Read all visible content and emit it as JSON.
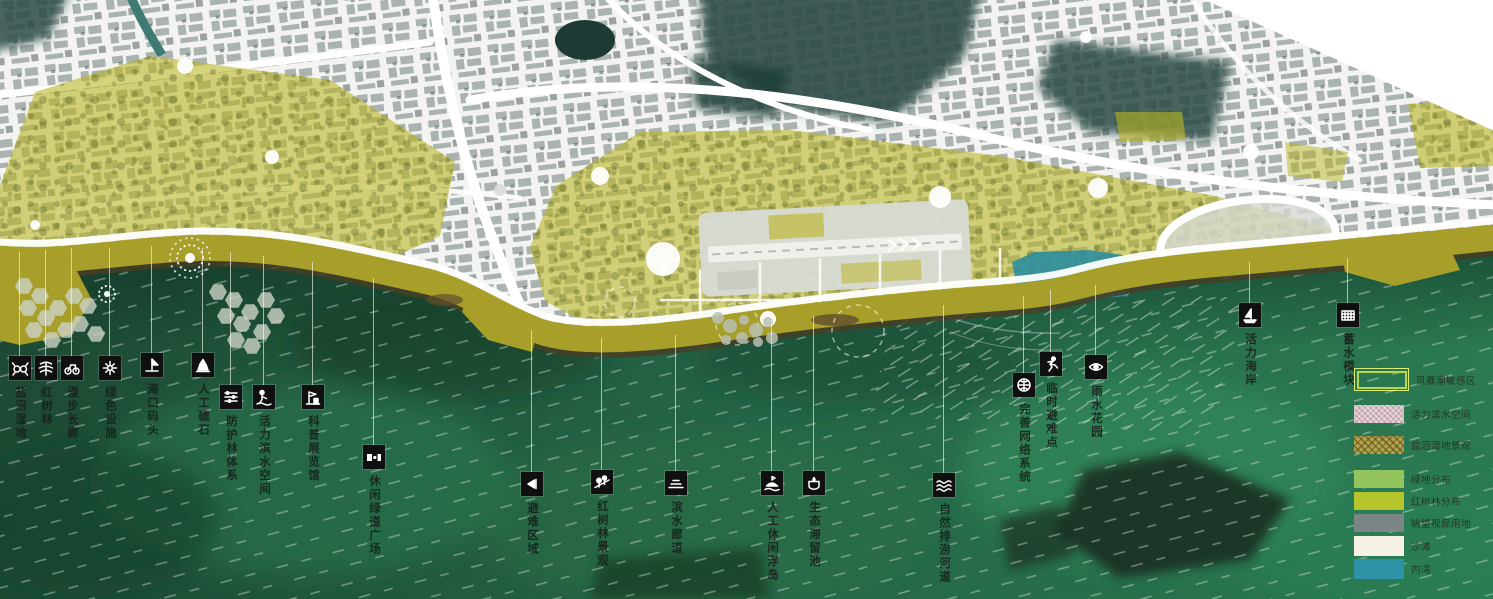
{
  "map": {
    "type": "coastal-urban-masterplan",
    "colors": {
      "sea_deep": "#1d4f38",
      "sea_light": "#2e8155",
      "coast_band": "#a89f2b",
      "coast_shadow": "#453e24",
      "overlay_olive": "#b9b41f",
      "city_base": "#f3f4f2",
      "hill_teal": "#2c4b46",
      "inner_bay": "#2e8e9e",
      "icon_bg": "#101010",
      "label_text": "#2c332e"
    }
  },
  "callouts": {
    "items": [
      {
        "label": "盐沼湿地",
        "icon": "salt-marsh-icon",
        "x": 20,
        "icon_y": 356,
        "line_from": 252
      },
      {
        "label": "红树林",
        "icon": "mangrove-tree-icon",
        "x": 46,
        "icon_y": 356,
        "line_from": 250
      },
      {
        "label": "漫步长廊",
        "icon": "bicycle-icon",
        "x": 72,
        "icon_y": 356,
        "line_from": 248
      },
      {
        "label": "绿色设施",
        "icon": "green-facility-icon",
        "x": 110,
        "icon_y": 356,
        "line_from": 248
      },
      {
        "label": "海口码头",
        "icon": "wharf-sail-icon",
        "x": 152,
        "icon_y": 353,
        "line_from": 246
      },
      {
        "label": "人工礁石",
        "icon": "reef-rock-icon",
        "x": 203,
        "icon_y": 353,
        "line_from": 248
      },
      {
        "label": "防护林体系",
        "icon": "shelter-forest-icon",
        "x": 231,
        "icon_y": 385,
        "line_from": 252
      },
      {
        "label": "活力滨水空间",
        "icon": "waterfront-space-icon",
        "x": 264,
        "icon_y": 385,
        "line_from": 256
      },
      {
        "label": "科普展览馆",
        "icon": "exhibition-hall-icon",
        "x": 313,
        "icon_y": 385,
        "line_from": 262
      },
      {
        "label": "休闲绿道广场",
        "icon": "greenway-plaza-icon",
        "x": 374,
        "icon_y": 445,
        "line_from": 278
      },
      {
        "label": "避难区域",
        "icon": "refuge-area-icon",
        "x": 532,
        "icon_y": 472,
        "line_from": 330
      },
      {
        "label": "红树林景观",
        "icon": "mangrove-view-icon",
        "x": 602,
        "icon_y": 470,
        "line_from": 338
      },
      {
        "label": "滨水廊道",
        "icon": "waterfront-corridor-icon",
        "x": 676,
        "icon_y": 471,
        "line_from": 335
      },
      {
        "label": "人工休闲浮岛",
        "icon": "floating-island-icon",
        "x": 772,
        "icon_y": 471,
        "line_from": 320
      },
      {
        "label": "生态滞留池",
        "icon": "retention-pond-icon",
        "x": 814,
        "icon_y": 471,
        "line_from": 316
      },
      {
        "label": "自然排涝河道",
        "icon": "drainage-channel-icon",
        "x": 944,
        "icon_y": 473,
        "line_from": 305
      },
      {
        "label": "完善网络系统",
        "icon": "network-system-icon",
        "x": 1024,
        "icon_y": 373,
        "line_from": 296
      },
      {
        "label": "临时避难点",
        "icon": "evacuation-point-icon",
        "x": 1051,
        "icon_y": 352,
        "line_from": 290
      },
      {
        "label": "雨水花园",
        "icon": "rain-garden-icon",
        "x": 1096,
        "icon_y": 355,
        "line_from": 285
      },
      {
        "label": "活力海岸",
        "icon": "active-coast-icon",
        "x": 1250,
        "icon_y": 303,
        "line_from": 262
      },
      {
        "label": "蓄水模块",
        "icon": "water-storage-icon",
        "x": 1348,
        "icon_y": 303,
        "line_from": 258
      }
    ]
  },
  "legend": {
    "items": [
      {
        "label": "风暴潮敏感区",
        "type": "outline",
        "color": "#b6d74c"
      },
      {
        "label": "活力滨水空间",
        "type": "hatch_pink",
        "color": "#c6a8b1"
      },
      {
        "label": "盐沼湿地景观",
        "type": "hatch_khaki",
        "color": "#b3a44c"
      },
      {
        "label": "绿地分布",
        "type": "solid",
        "color": "#93c35c"
      },
      {
        "label": "红树林分布",
        "type": "solid",
        "color": "#b5c52b"
      },
      {
        "label": "眺望视廊用地",
        "type": "solid",
        "color": "#7d8687"
      },
      {
        "label": "沙滩",
        "type": "solid",
        "color": "#f5f1e4"
      },
      {
        "label": "内湾",
        "type": "solid",
        "color": "#2f93a8"
      }
    ]
  }
}
